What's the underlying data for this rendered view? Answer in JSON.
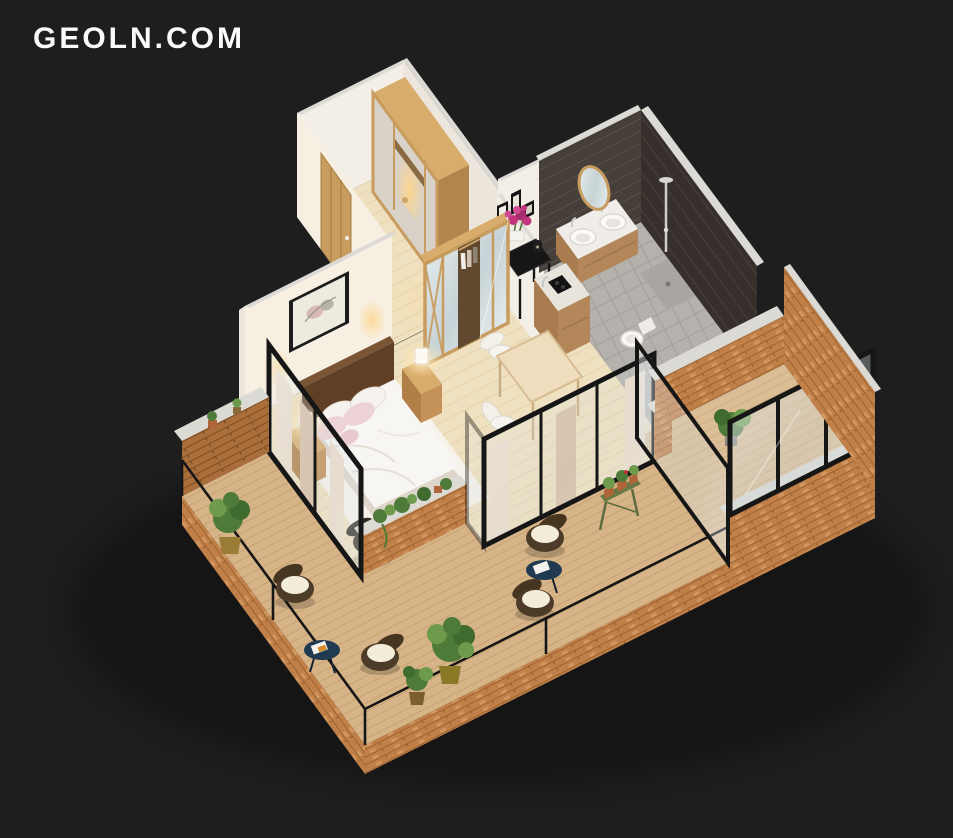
{
  "canvas": {
    "width": 953,
    "height": 838
  },
  "logo": {
    "text": "GEOLN.COM"
  },
  "palette": {
    "bg": "#1e1e1f",
    "logoColor": "#fafafa",
    "wall": "#f3eee6",
    "wallWarm": "#f7efe1",
    "wallShade": "#ece6dc",
    "cap": "#dcdad5",
    "floorWood": "#efe1c0",
    "floorLine": "#dcc49c",
    "deckWood": "#d6b488",
    "deckLine": "#bf9a67",
    "brick": "#c28049",
    "brickDark": "#9c6430",
    "brickLight": "#dfae76",
    "brickShadow": "#a96e3a",
    "frameBlack": "#161616",
    "curtain": "#ecdccb",
    "curtainDark": "#d9bfa6",
    "woodDark": "#5f4026",
    "woodMid": "#c89b5e",
    "woodLight": "#d8ac6b",
    "darkTile": "#463e39",
    "darkTile2": "#362f2b",
    "bathFloor": "#b5b1ac",
    "vanityWood": "#b3875a",
    "white": "#f8f6f2",
    "pillowPink": "#eed3d6",
    "navy": "#1f3a51",
    "green": "#4e7a3a",
    "greenLight": "#6d9a4b",
    "pot": "#7b5d2e",
    "terracotta": "#b0643a",
    "magenta": "#c2357e",
    "glow": "#ffd68c"
  },
  "scene": {
    "type": "isometric-3d-floor-plan-render",
    "description": "Cut-away 3D render of a studio apartment with wrap-around wooden terrace on a dark background",
    "rooms": [
      {
        "name": "entry-hall",
        "items": [
          "wooden entrance door",
          "hallway wardrobe with lit niche",
          "wood floor"
        ]
      },
      {
        "name": "hallway",
        "items": [
          "black console table",
          "magenta flowers in white planter",
          "black candle lantern",
          "gallery wall frames"
        ]
      },
      {
        "name": "bedroom",
        "items": [
          "double bed with white duvet",
          "pink and white pillows",
          "dark wood headboard",
          "framed wall art",
          "two nightstands",
          "two glowing table lamps",
          "mirrored wardrobe with wood cross frame",
          "white rug",
          "dark accent chair"
        ]
      },
      {
        "name": "dining-nook",
        "items": [
          "small dining table",
          "two white chairs"
        ]
      },
      {
        "name": "kitchen-nook",
        "items": [
          "wood counter",
          "black induction hob",
          "steel faucet",
          "white partition wall"
        ]
      },
      {
        "name": "bathroom",
        "items": [
          "dark tiled walls",
          "wood vanity with two round vessel sinks",
          "round mirror",
          "walk-in shower with chrome column",
          "toilet",
          "grey tile floor"
        ]
      },
      {
        "name": "terrace",
        "items": [
          "diagonal wood deck",
          "brick parapet walls with concrete caps",
          "thin black railing",
          "glazed enclosure with black frames",
          "four wicker armchairs with white cushions",
          "two navy round side tables with magazines",
          "potted bushes",
          "green plant stand with terracotta pots",
          "brick planter with trailing greenery",
          "beige curtains behind sliding glass walls"
        ]
      }
    ]
  }
}
